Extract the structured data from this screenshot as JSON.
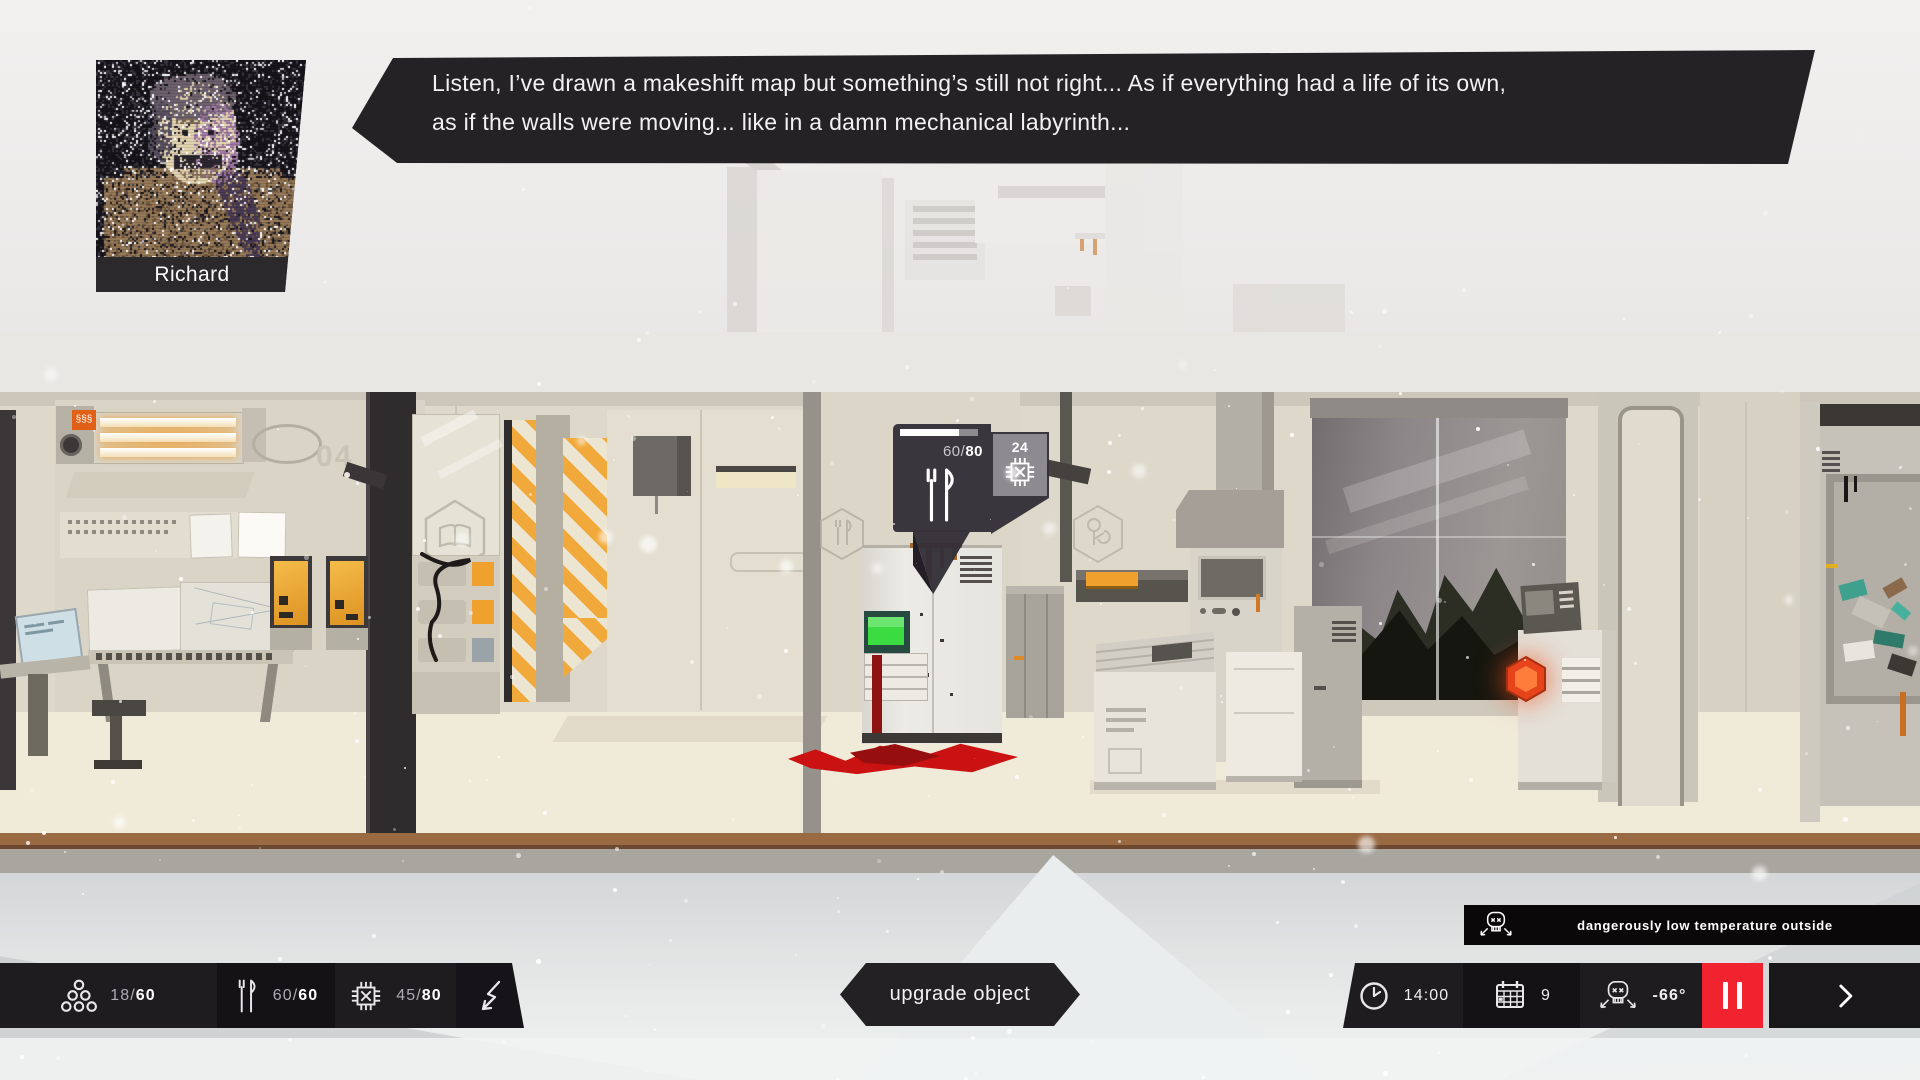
{
  "dialog": {
    "speaker_name": "Richard",
    "text_line1": "Listen, I’ve drawn a makeshift map but something’s still not right... As if everything had a life of its own,",
    "text_line2": "as if the walls were moving... like in a damn mechanical labyrinth..."
  },
  "tooltip": {
    "selected_object": "food storage",
    "durability_current": "60",
    "durability_max": "80",
    "sep": "/",
    "upgrade_cost": "24",
    "progress_percent": 75
  },
  "hud": {
    "sep": "/",
    "resources": {
      "colonists": {
        "current": "18",
        "max": "60"
      },
      "food": {
        "current": "60",
        "max": "60"
      },
      "materials": {
        "current": "45",
        "max": "80"
      }
    },
    "action_button": "upgrade object",
    "clock": {
      "time": "14:00",
      "day": "9",
      "temperature": "-66°"
    },
    "warning": "dangerously low temperature outside"
  },
  "scene": {
    "wall_number": "04",
    "heater_badge": "§§§"
  },
  "colors": {
    "ui_dark": "#232124",
    "ui_dark_alt": "#141215",
    "pause_red": "#f1232e",
    "hazard_orange": "#f2a93b",
    "screen_green": "#3bdc42",
    "blood_red": "#cb1212",
    "tooltip_gray": "#8e8b90",
    "wall_beige": "#ddd8ca",
    "floor_brown": "#9a6a43"
  }
}
